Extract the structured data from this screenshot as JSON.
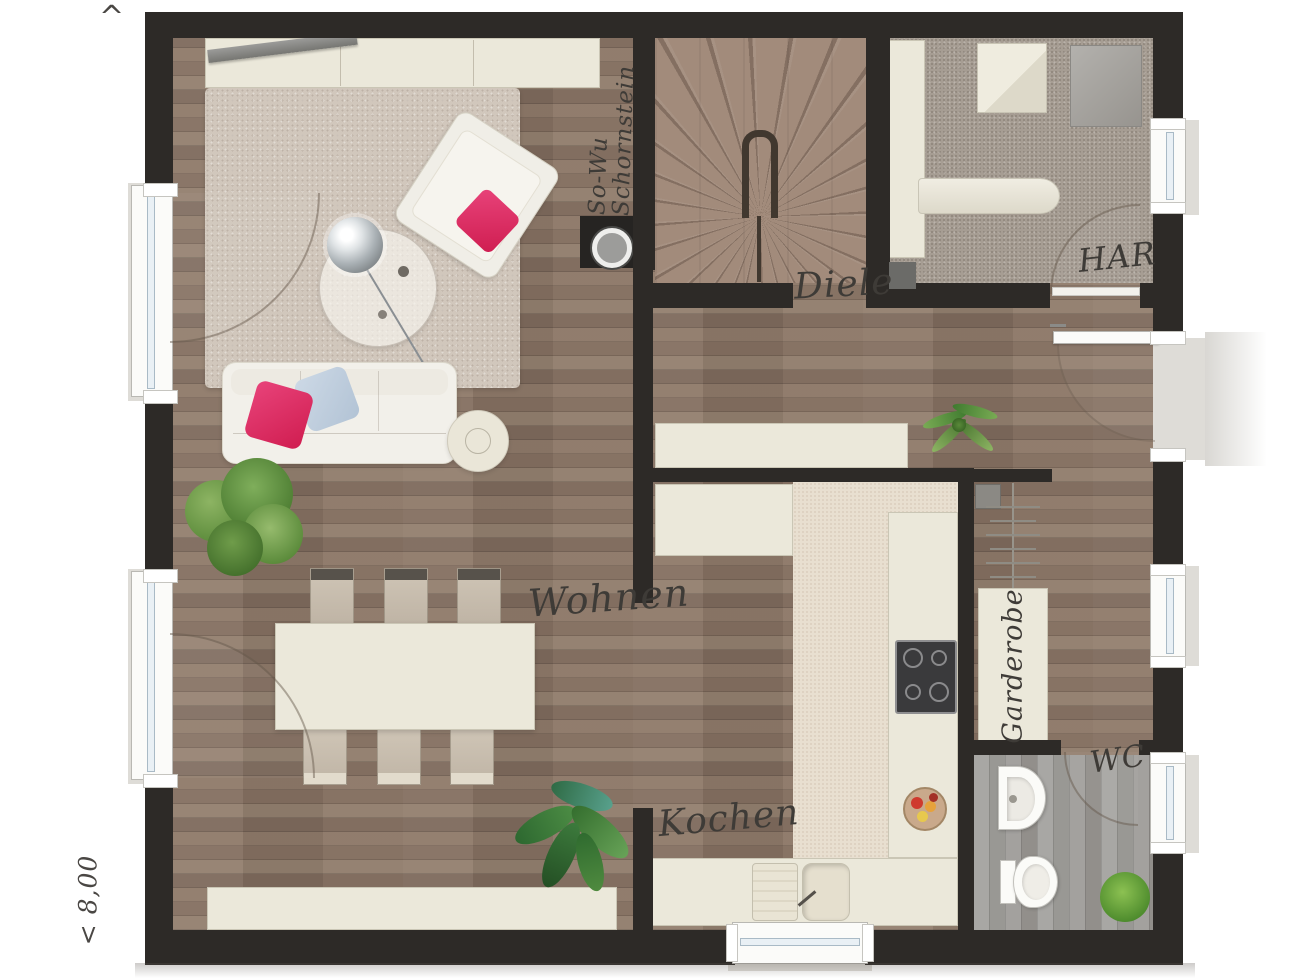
{
  "annotations": {
    "top_marker": "^",
    "left_dimension": "< 8,00",
    "chimney_label_line1": "So-Wu",
    "chimney_label_line2": "Schornstein"
  },
  "rooms": {
    "wohnen": {
      "label": "Wohnen"
    },
    "kochen": {
      "label": "Kochen"
    },
    "diele": {
      "label": "Diele"
    },
    "har": {
      "label": "HAR"
    },
    "wc": {
      "label": "WC"
    },
    "garderobe": {
      "label": "Garderobe"
    }
  },
  "colors": {
    "wall": "#2d2a27",
    "wood_floor": "#8d7868",
    "har_floor": "#a69d93",
    "wc_floor": "#a09e9b",
    "kitchen_tile": "#e8dfd0",
    "furniture_cream": "#ebe8da",
    "pillow_pink": "#dd2a5b",
    "pillow_blue": "#bccfe0",
    "plant_green": "#578a38"
  }
}
